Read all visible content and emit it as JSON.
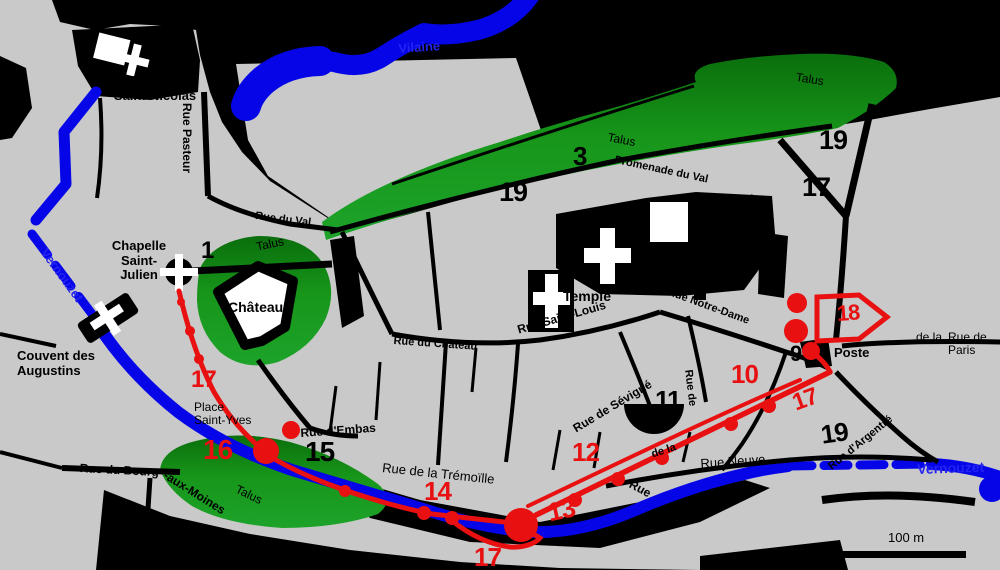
{
  "colors": {
    "background": "#c9c9c9",
    "water_blue": "#0505e8",
    "talus_green": "#17961a",
    "wall_red": "#e81010",
    "ink_black": "#000000"
  },
  "water": {
    "vilaine": "Vilaine",
    "vernouzet_upper": "Vernouzet",
    "vernouzet_lower": "Vernouzet"
  },
  "terrain": {
    "talus_north": "Talus",
    "talus_band": "Talus",
    "talus_chateau": "Talus",
    "talus_southwest": "Talus"
  },
  "places": {
    "chapelle_saint_nicolas_l1": "Chapelle",
    "chapelle_saint_nicolas_l2": "Saint-Nicolas",
    "chapelle_saint_julien_l1": "Chapelle",
    "chapelle_saint_julien_l2": "Saint-",
    "chapelle_saint_julien_l3": "Julien",
    "couvent_augustins_l1": "Couvent des",
    "couvent_augustins_l2": "Augustins",
    "couvent_benedictins_l1": "Couvent des",
    "couvent_benedictins_l2": "Bénédictins",
    "place_marchix_l1": "Place du",
    "place_marchix_l2": "Marchix",
    "place_saint_yves_l1": "Place",
    "place_saint_yves_l2": "Saint-Yves",
    "chateau": "Château",
    "temple": "Temple",
    "poste": "Poste"
  },
  "streets": {
    "rue_pasteur": "Rue Pasteur",
    "rue_du_val": "Rue du Val",
    "promenade_du_val": "Promenade du Val",
    "rue_saint_louis": "Rue Saint-Louis",
    "rue_notre_dame": "Rue Notre-Dame",
    "rue_du_chateau": "Rue du Château",
    "rue_d_embas": "Rue d'Embas",
    "rue_de_la_tremoille": "Rue de la Trémoïlle",
    "rue_de_sevigne": "Rue de Sévigné",
    "rue_neuve": "Rue Neuve",
    "rue_du_bourg": "Rue du Bourg",
    "aux_moines": "-aux-Moines",
    "rue_de_paris_l1": "Rue de",
    "rue_de_paris_l2": "Paris",
    "de_la_fragment": "de la",
    "rue_d_argentre": "Rue d'Argentré",
    "rue_vertical_fragment": "Rue de",
    "wall_street_fragment": "de la",
    "rue_fragment": "Rue",
    "rue_de_la_fragment": "Rue de la",
    "croix_fragment": "Cro"
  },
  "numbers": {
    "site_1": "1",
    "site_3": "3",
    "site_9": "9",
    "site_10": "10",
    "site_11": "11",
    "site_12": "12",
    "site_13": "13",
    "site_14": "14",
    "site_15": "15",
    "site_16": "16",
    "site_17_west": "17",
    "site_17_east": "17",
    "site_17_south": "17",
    "site_17_northeast": "17",
    "site_18": "18",
    "site_19_promenade": "19",
    "site_19_northeast": "19",
    "site_19_southeast": "19"
  },
  "scale": {
    "label": "100 m"
  }
}
